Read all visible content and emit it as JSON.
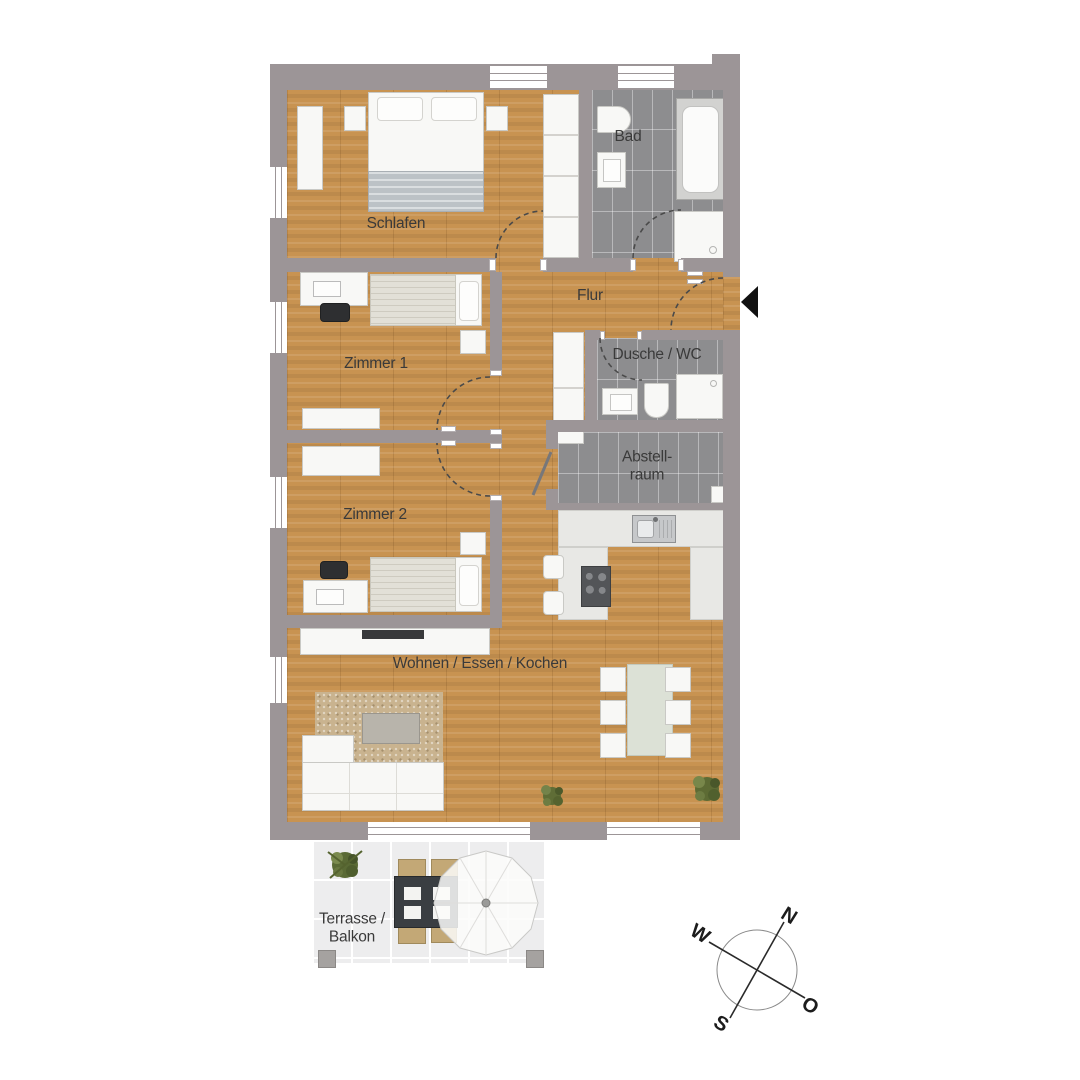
{
  "rooms": {
    "schlafen": {
      "label": "Schlafen"
    },
    "bad": {
      "label": "Bad"
    },
    "flur": {
      "label": "Flur"
    },
    "zimmer1": {
      "label": "Zimmer 1"
    },
    "dusche_wc": {
      "label": "Dusche / WC"
    },
    "abstellraum": {
      "label_line1": "Abstell-",
      "label_line2": "raum"
    },
    "zimmer2": {
      "label": "Zimmer 2"
    },
    "wohnen": {
      "label": "Wohnen / Essen / Kochen"
    },
    "terrasse": {
      "label_line1": "Terrasse /",
      "label_line2": "Balkon"
    }
  },
  "compass": {
    "north": "N",
    "east": "O",
    "south": "S",
    "west": "W"
  },
  "colors": {
    "wall": "#9c9597",
    "wood": "#c89351",
    "tile": "#8d8d8f",
    "terrace": "#ededee",
    "furn": "#f8f8f6",
    "counter": "#e8e8e5",
    "text": "#3a3a3a",
    "dark": "#2e2f31"
  }
}
